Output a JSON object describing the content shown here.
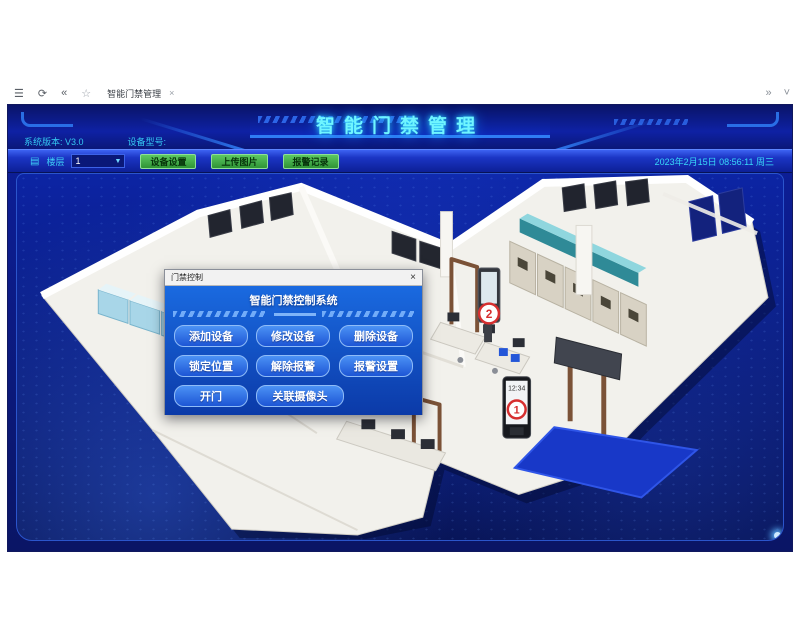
{
  "browser": {
    "menu_icon": "☰",
    "refresh_icon": "⟳",
    "back_icon": "«",
    "home_icon": "☆",
    "tab_title": "智能门禁管理",
    "tab_close": "×",
    "overflow_icon": "»",
    "dropdown_icon": "˅"
  },
  "header": {
    "title": "智能门禁管理",
    "version_label": "系统版本: V3.0",
    "model_label": "设备型号:"
  },
  "toolbar": {
    "floor_label": "楼层",
    "floor_value": "1",
    "caret": "▼",
    "buttons": [
      "设备设置",
      "上传图片",
      "报警记录"
    ],
    "datetime": "2023年2月15日 08:56:11 周三"
  },
  "dialog": {
    "title": "门禁控制",
    "close": "×",
    "heading": "智能门禁控制系统",
    "rows": [
      [
        "添加设备",
        "修改设备",
        "删除设备"
      ],
      [
        "锁定位置",
        "解除报警",
        "报警设置"
      ],
      [
        "开门",
        "关联摄像头"
      ]
    ]
  },
  "map": {
    "device_1": {
      "badge": "1",
      "screen_time": "12:34"
    },
    "device_2": {
      "badge": "2"
    }
  },
  "colors": {
    "accent_cyan": "#6ff5ff",
    "header_blue": "#0e21a4",
    "button_green": "#3fae46",
    "dialog_blue": "#1a6ae0",
    "badge_red": "#d62f2f",
    "map_bg": "#0a1f9e",
    "mat_blue": "#1838c8"
  }
}
